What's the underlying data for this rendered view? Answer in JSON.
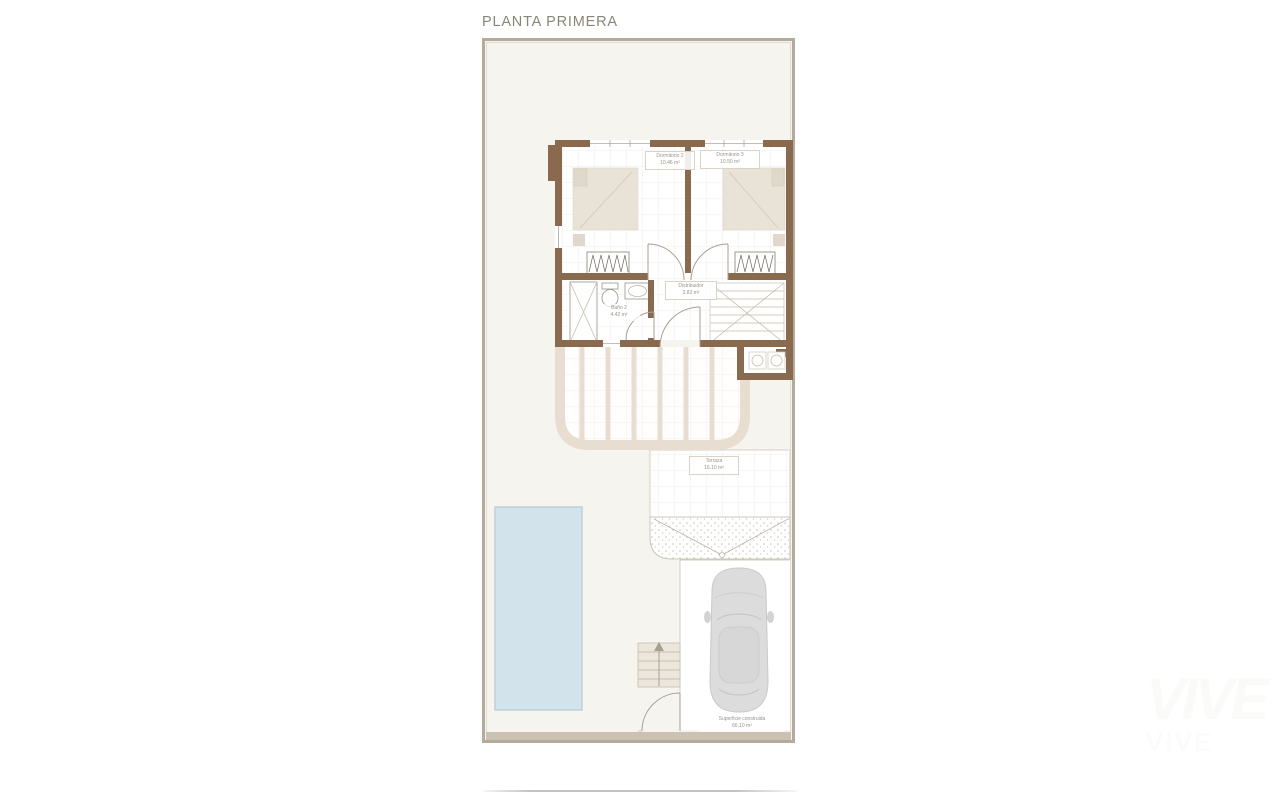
{
  "page": {
    "title": "PLANTA PRIMERA",
    "watermark_big": "VIVE",
    "watermark_small": "VIVE"
  },
  "plan": {
    "rooms": {
      "dormitorio2": {
        "name": "Dormitorio 2",
        "area": "10.46 m²"
      },
      "dormitorio3": {
        "name": "Dormitorio 3",
        "area": "10.50 m²"
      },
      "bano2": {
        "name": "Baño 2",
        "area": "4.42 m²"
      },
      "distribuidor": {
        "name": "Distribuidor",
        "area": "3.82 m²"
      },
      "terraza": {
        "name": "Terraza",
        "area": "16.10 m²"
      }
    },
    "summary": {
      "label": "Superficie construida",
      "value": "66.10 m²"
    },
    "features": {
      "pool": "swimming-pool",
      "car": "car-top-view",
      "balcony": "curved-balcony-with-railing",
      "interior_stairs": "interior-staircase",
      "exterior_stairs": "exterior-staircase-with-up-arrow",
      "awning": "stippled-curved-awning"
    },
    "colors": {
      "wall": "#8a6a4f",
      "plot_fill": "#f6f4ef",
      "plot_border": "#b5ab9d",
      "balcony_parapet": "#e7ddd0",
      "pool": "#d2e3eb",
      "furniture": "#e9e2d7",
      "car": "#dcdcdc",
      "label_text": "#9a9488"
    }
  }
}
